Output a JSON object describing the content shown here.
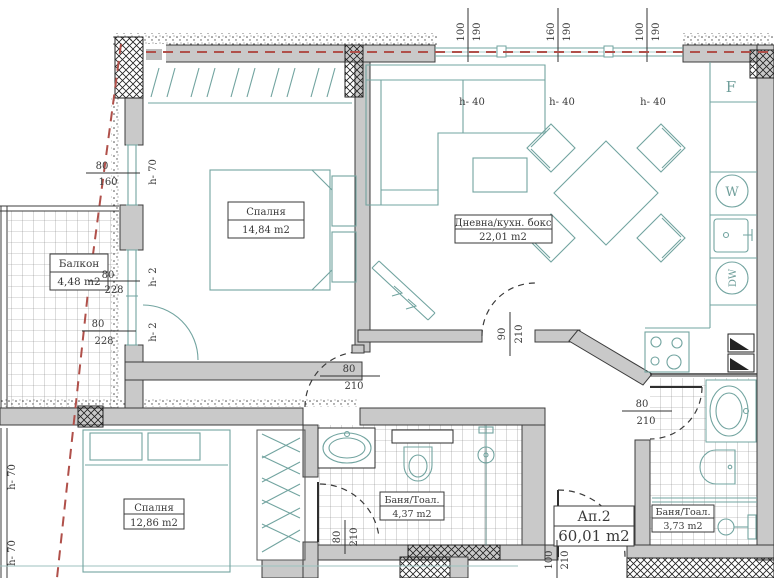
{
  "plan": {
    "apartment": {
      "label": "Ап.2",
      "area": "60,01 m2"
    },
    "rooms": {
      "bedroom_top": {
        "name": "Спалня",
        "area": "14,84 m2"
      },
      "living": {
        "name": "Дневна/кухн. бокс",
        "area": "22,01 m2"
      },
      "balcony": {
        "name": "Балкон",
        "area": "4,48 m2"
      },
      "bedroom_bottom": {
        "name": "Спалня",
        "area": "12,86 m2"
      },
      "bath_mid": {
        "name": "Баня/Тоал.",
        "area": "4,37 m2"
      },
      "bath_right": {
        "name": "Баня/Тоал.",
        "area": "3,73 m2"
      }
    },
    "appliances": {
      "fridge": "F",
      "washer": "W",
      "dishwasher": "DW"
    },
    "dims": {
      "top1w": "100",
      "top1h": "190",
      "top2w": "160",
      "top2h": "190",
      "top3w": "100",
      "top3h": "190",
      "leftw": "80",
      "lefth": "160",
      "bal1w": "80",
      "bal1h": "228",
      "bal2w": "80",
      "bal2h": "228",
      "livw": "90",
      "livh": "210",
      "hallw": "80",
      "hallh": "210",
      "bath1w": "80",
      "bath1h": "210",
      "bath2w": "80",
      "bath2h": "210",
      "entw": "100",
      "enth": "210"
    },
    "sills": {
      "h70a": "h- 70",
      "h70b": "h- 70",
      "h70c": "h- 70",
      "h2a": "h- 2",
      "h2b": "h- 2",
      "h40a": "h- 40",
      "h40b": "h- 40",
      "h40c": "h- 40"
    },
    "colors": {
      "furniture_line": "#72a4a0",
      "wall_fill": "#c9c9c9",
      "wall_stroke": "#3c3c3c",
      "boundary_red": "#b0504a",
      "tile_line": "#8a8a8a",
      "text": "#3a3a3a"
    }
  }
}
